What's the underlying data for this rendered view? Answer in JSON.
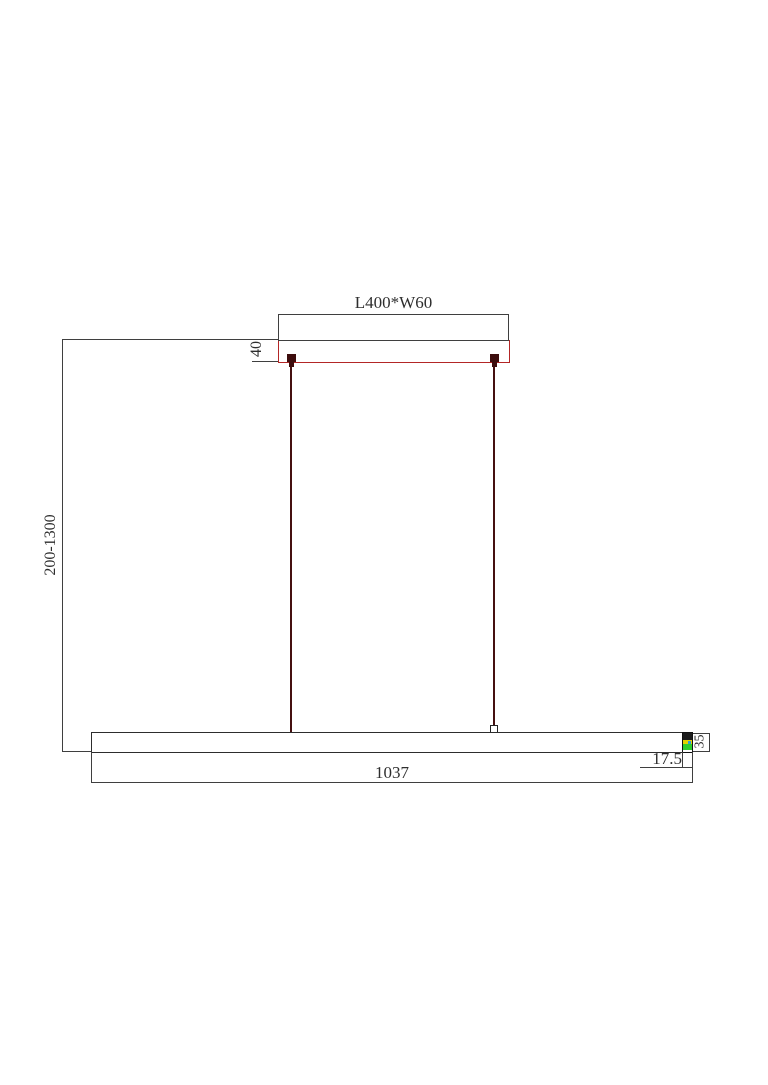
{
  "drawing": {
    "type": "technical-dimension-diagram",
    "subject": "linear pendant light fixture elevation",
    "dimensions": {
      "canopy_size": "L400*W60",
      "canopy_height": "40",
      "suspension_range": "200-1300",
      "fixture_length": "1037",
      "endcap_width": "17.5",
      "fixture_height": "35"
    },
    "colors": {
      "line": "#3f3f3f",
      "canopy_outline": "#b32626",
      "cable": "#451010",
      "endcap_green": "#2ecc2e",
      "endcap_yellow": "#e2d200",
      "endcap_blue": "#2f9fd1",
      "background": "#ffffff"
    }
  }
}
